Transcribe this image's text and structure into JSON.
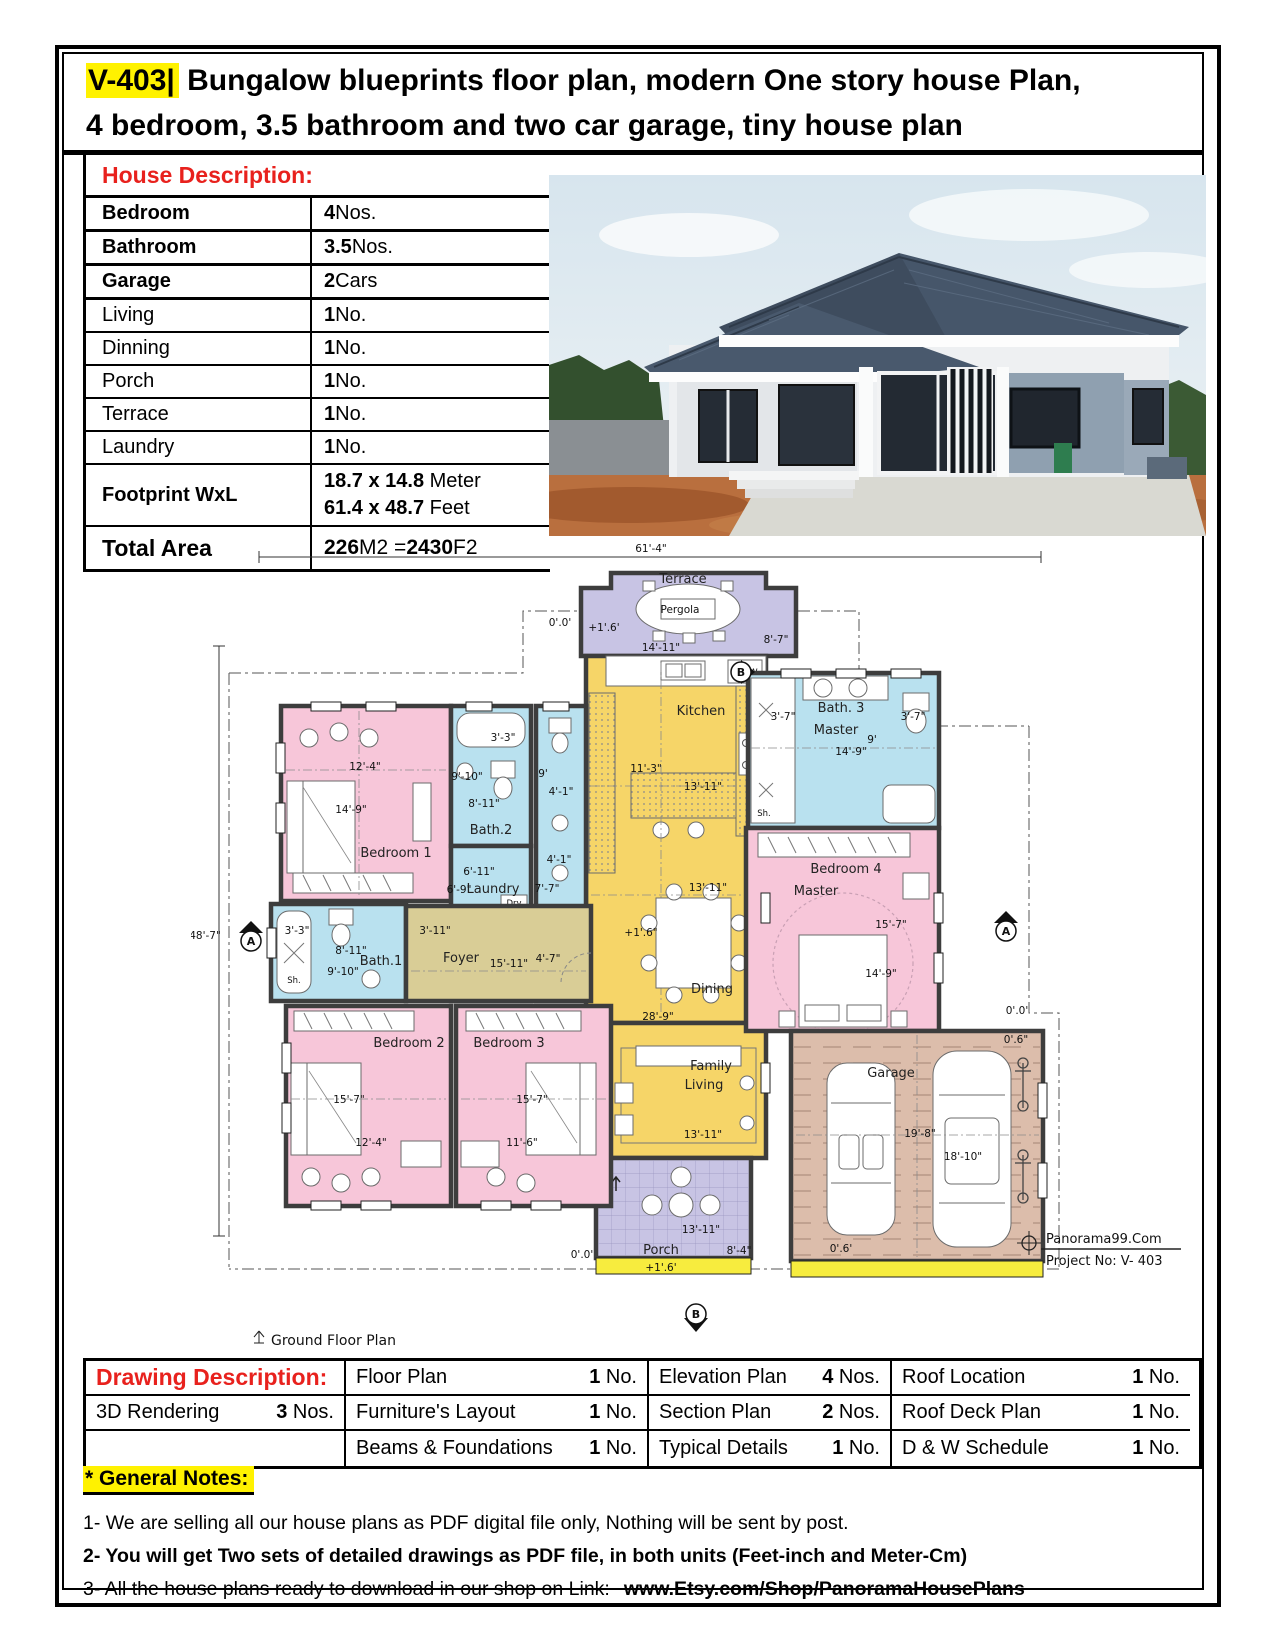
{
  "header": {
    "code": "V-403|",
    "line1": " Bungalow blueprints floor plan, modern One story house Plan,",
    "line2": "4 bedroom, 3.5 bathroom and two car garage, tiny house plan"
  },
  "house": {
    "title": "House Description:",
    "rows": [
      {
        "label": "Bedroom",
        "v1": "4",
        "v2": " Nos."
      },
      {
        "label": "Bathroom",
        "v1": "3.5",
        "v2": " Nos."
      },
      {
        "label": "Garage",
        "v1": "2",
        "v2": " Cars"
      },
      {
        "label": "Living",
        "v1": "1",
        "v2": " No."
      },
      {
        "label": "Dinning",
        "v1": "1",
        "v2": " No."
      },
      {
        "label": "Porch",
        "v1": "1",
        "v2": " No."
      },
      {
        "label": "Terrace",
        "v1": "1",
        "v2": " No."
      },
      {
        "label": "Laundry",
        "v1": "1",
        "v2": " No."
      }
    ],
    "footprint": {
      "label": "Footprint WxL",
      "m_num": "18.7 x 14.8",
      "m_unit": " Meter",
      "f_num": "61.4 x 48.7",
      "f_unit": " Feet"
    },
    "total": {
      "label": "Total Area",
      "n1": "226",
      "mid": " M2 = ",
      "n2": "2430",
      "end": " F2"
    }
  },
  "drawing": {
    "title": "Drawing Description:",
    "r1c2": {
      "label": "Floor Plan",
      "n": "1",
      "u": " No."
    },
    "r1c3": {
      "label": "Elevation Plan",
      "n": "4",
      "u": " Nos."
    },
    "r1c4": {
      "label": "Roof Location",
      "n": "1",
      "u": " No."
    },
    "r2c1": {
      "label": "3D Rendering",
      "n": "3",
      "u": " Nos."
    },
    "r2c2": {
      "label": "Furniture's Layout",
      "n": "1",
      "u": " No."
    },
    "r2c3": {
      "label": "Section Plan",
      "n": "2",
      "u": " Nos."
    },
    "r2c4": {
      "label": "Roof Deck Plan",
      "n": "1",
      "u": " No."
    },
    "r3c2": {
      "label": "Beams & Foundations",
      "n": "1",
      "u": " No."
    },
    "r3c3": {
      "label": "Typical Details",
      "n": "1",
      "u": " No."
    },
    "r3c4": {
      "label": "D & W Schedule",
      "n": "1",
      "u": " No."
    }
  },
  "notes": {
    "heading": "* General Notes:",
    "n1": "1- We are selling all our house plans as PDF digital file only, Nothing will be sent by post.",
    "n2": "2- You will get Two sets of detailed drawings as PDF file, in both units (Feet-inch and Meter-Cm)",
    "n3_prefix": "3- All the house plans ready to download in our shop on Link:",
    "n3_link": "www.Etsy.com/Shop/PanoramaHousePlans"
  },
  "plan": {
    "dim_w": "61'-4\"",
    "dim_h": "48'-7\"",
    "terrace": "Terrace",
    "pergola": "Pergola",
    "terrace_w": "14'-11\"",
    "terrace_s": "8'-7\"",
    "kitchen": "Kitchen",
    "kitchen_h": "11'-3\"",
    "kitchen_w": "13'-11\"",
    "dw": "DW.",
    "dining": "Dining",
    "dining_w": "13'-11\"",
    "overall_h": "28'-9\"",
    "family1": "Family",
    "family2": "Living",
    "family_w": "13'-11\"",
    "porch": "Porch",
    "porch_w": "13'-11\"",
    "porch_d": "8'-4\"",
    "lvl0": "0'.0'",
    "lvl16": "+1'.6'",
    "lvl16in": "+1'.6\"",
    "lvl06in": "0'.6\"",
    "lvl06": "0'.6'",
    "bath3a": "Bath. 3",
    "bath3b": "Master",
    "bath3_1": "3'-7\"",
    "bath3_2": "3'-7\"",
    "bath3_3": "9'",
    "bath3_w": "14'-9\"",
    "sh": "Sh.",
    "bed4a": "Bedroom 4",
    "bed4b": "Master",
    "bed4_w": "15'-7\"",
    "bed4_h": "14'-9\"",
    "garage": "Garage",
    "garage_w": "19'-8\"",
    "garage_h": "18'-10\"",
    "bed1": "Bedroom 1",
    "bed1_w": "12'-4\"",
    "bed1_h": "14'-9\"",
    "bed2": "Bedroom 2",
    "bed2_w": "15'-7\"",
    "bed2_h": "12'-4\"",
    "bed3": "Bedroom 3",
    "bed3_w": "15'-7\"",
    "bed3_h": "11'-6\"",
    "bath2": "Bath.2",
    "bath2_1": "3'-3\"",
    "bath2_2": "9'-10\"",
    "bath2_3": "8'-11\"",
    "bath2_4": "9'",
    "bath2_5": "4'-1\"",
    "bath2_6": "4'-1\"",
    "bath2_7": "7'-7\"",
    "laundry": "Laundry",
    "laundry_1": "6'-11\"",
    "laundry_2": "6'-9\"",
    "dry": "Dry",
    "wash": "Wash",
    "bath1": "Bath.1",
    "bath1_1": "3'-3\"",
    "bath1_2": "8'-11\"",
    "bath1_3": "9'-10\"",
    "foyer": "Foyer",
    "foyer_1": "3'-11\"",
    "foyer_w": "15'-11\"",
    "foyer_2": "4'-7\"",
    "mA": "A",
    "mB": "B",
    "ground": "Ground Floor Plan",
    "brand": "Panorama99.Com",
    "project": "Project No: V- 403"
  },
  "colors": {
    "accent_red": "#e8211d",
    "highlight_yellow": "#fff200",
    "room_pink": "#f7c6d9",
    "room_blue": "#b9e1ef",
    "room_yellow": "#f6d568",
    "room_tan": "#d9cd96",
    "room_purple": "#c8c4e4",
    "room_garage": "#dcbdab",
    "strip_yellow": "#f7ec3e",
    "wall_gray": "#3d3d3d"
  }
}
